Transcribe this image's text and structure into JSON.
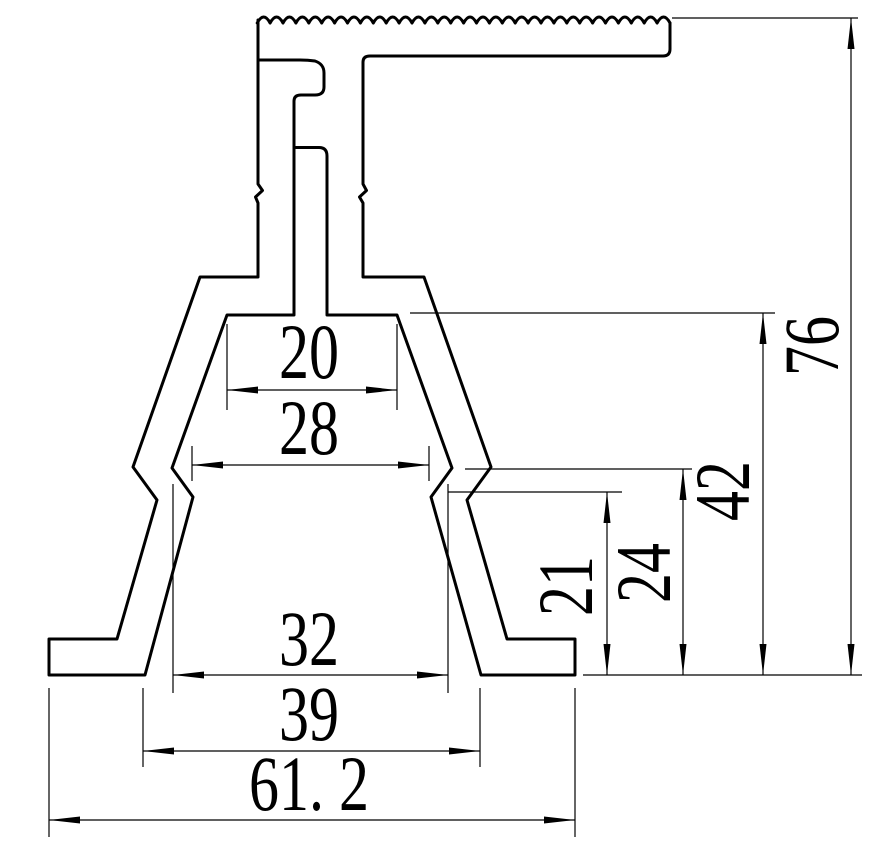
{
  "drawing": {
    "title": "Aluminum profile cross-section technical drawing",
    "background_color": "#ffffff",
    "line_color": "#000000"
  },
  "dimensions": {
    "horizontal": [
      {
        "name": "inner-top-width",
        "label": "20",
        "value": 20
      },
      {
        "name": "kink-upper-width",
        "label": "28",
        "value": 28
      },
      {
        "name": "legs-inner-span",
        "label": "32",
        "value": 32
      },
      {
        "name": "legs-outer-span",
        "label": "39",
        "value": 39
      },
      {
        "name": "overall-width",
        "label": "61. 2",
        "value": 61.2
      }
    ],
    "vertical": [
      {
        "name": "kink-lower-height",
        "label": "21",
        "value": 21
      },
      {
        "name": "kink-upper-height",
        "label": "24",
        "value": 24
      },
      {
        "name": "cavity-height",
        "label": "42",
        "value": 42
      },
      {
        "name": "overall-height",
        "label": "76",
        "value": 76
      }
    ]
  }
}
